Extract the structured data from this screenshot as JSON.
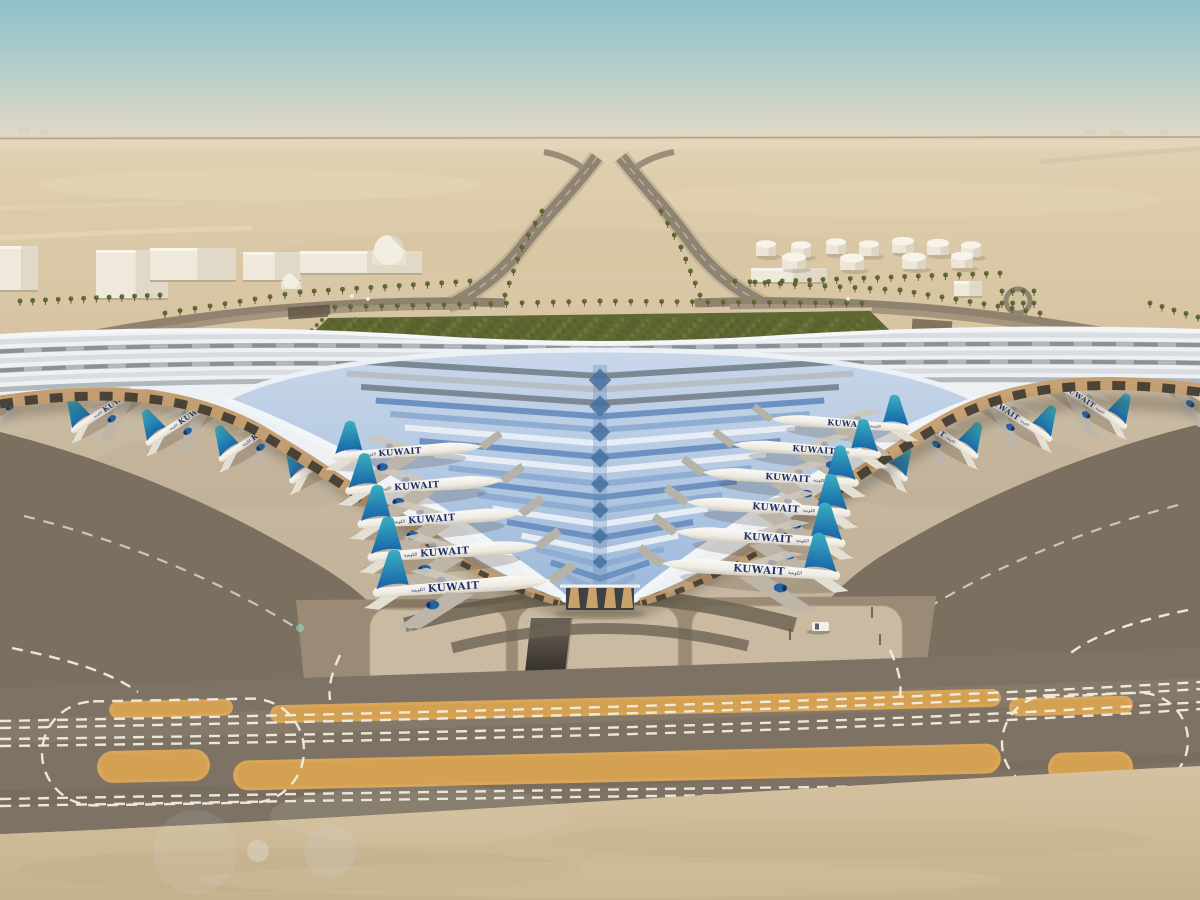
{
  "meta": {
    "title": "Aerial rendering of Kuwait International Airport Terminal 2 with Kuwait Airways fleet at gates",
    "scene_type": "architectural-rendering",
    "view": "aerial-oblique"
  },
  "airline": {
    "name": "KUWAIT",
    "arabic": "الكويتية",
    "wordmark_color": "#1d2e6b",
    "tail_teal": "#39b0bf",
    "tail_blue": "#1763a8"
  },
  "palette": {
    "sky_top": "#8fc2cb",
    "sky_horizon": "#e3d9c6",
    "desert": "#dbc9a8",
    "sand_foreground": "#d3c09e",
    "concrete_apron": "#c7b89f",
    "asphalt": "#7b7060",
    "taxiway_band": "#7d7264",
    "marking_white": "#f3eee1",
    "island_orange": "#d9a558",
    "roof_white": "#eef1f3",
    "glass_blue": "#9db8da",
    "glass_deep": "#47719f",
    "canopy_amber": "#c49d6e",
    "landscape_green": "#5f6833",
    "building_white": "#efe9db",
    "tank_white": "#ece6d8"
  },
  "counts": {
    "aircraft_visible": 21,
    "fuel_tanks": 11
  },
  "aircraft": {
    "left_concourse": [
      {
        "x": 402,
        "y": 452,
        "s": 0.94,
        "r": -4
      },
      {
        "x": 419,
        "y": 486,
        "s": 0.99,
        "r": -4
      },
      {
        "x": 434,
        "y": 519,
        "s": 1.03,
        "r": -4
      },
      {
        "x": 447,
        "y": 552,
        "s": 1.07,
        "r": -4
      },
      {
        "x": 456,
        "y": 587,
        "s": 1.12,
        "r": -4
      }
    ],
    "right_concourse": [
      {
        "x": 846,
        "y": 424,
        "s": 0.88,
        "r": -4
      },
      {
        "x": 812,
        "y": 450,
        "s": 0.93,
        "r": -4
      },
      {
        "x": 786,
        "y": 478,
        "s": 0.98,
        "r": -4
      },
      {
        "x": 774,
        "y": 508,
        "s": 1.03,
        "r": -4
      },
      {
        "x": 766,
        "y": 538,
        "s": 1.07,
        "r": -4
      },
      {
        "x": 757,
        "y": 570,
        "s": 1.12,
        "r": -4
      }
    ],
    "left_pier": [
      {
        "x": 18,
        "y": 388,
        "s": 0.78,
        "r": -33
      },
      {
        "x": 120,
        "y": 400,
        "s": 0.78,
        "r": -33
      },
      {
        "x": 196,
        "y": 412,
        "s": 0.8,
        "r": -33
      },
      {
        "x": 269,
        "y": 428,
        "s": 0.8,
        "r": -33
      },
      {
        "x": 341,
        "y": 449,
        "s": 0.82,
        "r": -33
      }
    ],
    "right_pier": [
      {
        "x": 1182,
        "y": 385,
        "s": 0.78,
        "r": -33
      },
      {
        "x": 1078,
        "y": 396,
        "s": 0.78,
        "r": -33
      },
      {
        "x": 1002,
        "y": 408,
        "s": 0.8,
        "r": -33
      },
      {
        "x": 928,
        "y": 425,
        "s": 0.8,
        "r": -33
      },
      {
        "x": 856,
        "y": 447,
        "s": 0.82,
        "r": -33
      }
    ]
  },
  "fuel_tanks": [
    {
      "x": 766,
      "y": 250,
      "r": 10
    },
    {
      "x": 801,
      "y": 251,
      "r": 10
    },
    {
      "x": 836,
      "y": 248,
      "r": 10
    },
    {
      "x": 869,
      "y": 250,
      "r": 10
    },
    {
      "x": 903,
      "y": 247,
      "r": 11
    },
    {
      "x": 938,
      "y": 249,
      "r": 11
    },
    {
      "x": 971,
      "y": 251,
      "r": 10
    },
    {
      "x": 794,
      "y": 263,
      "r": 12
    },
    {
      "x": 852,
      "y": 264,
      "r": 12
    },
    {
      "x": 914,
      "y": 263,
      "r": 12
    },
    {
      "x": 962,
      "y": 262,
      "r": 11
    }
  ],
  "buildings": [
    {
      "x": 0,
      "y": 246,
      "w": 38,
      "h": 46
    },
    {
      "x": 96,
      "y": 250,
      "w": 72,
      "h": 50
    },
    {
      "x": 150,
      "y": 248,
      "w": 86,
      "h": 34
    },
    {
      "x": 243,
      "y": 252,
      "w": 58,
      "h": 30
    },
    {
      "x": 300,
      "y": 251,
      "w": 122,
      "h": 24
    },
    {
      "x": 751,
      "y": 268,
      "w": 76,
      "h": 16
    },
    {
      "x": 954,
      "y": 281,
      "w": 28,
      "h": 17
    }
  ],
  "domes": [
    {
      "x": 389,
      "y": 250,
      "r": 15
    },
    {
      "x": 291,
      "y": 281,
      "r": 8
    }
  ],
  "palm_rows": [
    {
      "step": 15,
      "pts": [
        [
          335,
          312
        ],
        [
          600,
          306
        ],
        [
          862,
          308
        ]
      ]
    },
    {
      "step": 14,
      "pts": [
        [
          165,
          318
        ],
        [
          300,
          297
        ],
        [
          470,
          286
        ]
      ]
    },
    {
      "step": 14,
      "pts": [
        [
          1040,
          318
        ],
        [
          900,
          295
        ],
        [
          735,
          286
        ]
      ]
    },
    {
      "step": 12,
      "pts": [
        [
          505,
          300
        ],
        [
          522,
          252
        ],
        [
          542,
          216
        ]
      ]
    },
    {
      "step": 12,
      "pts": [
        [
          700,
          300
        ],
        [
          681,
          252
        ],
        [
          661,
          216
        ]
      ]
    },
    {
      "step": 13,
      "pts": [
        [
          755,
          287
        ],
        [
          1000,
          278
        ]
      ]
    },
    {
      "step": 12,
      "pts": [
        [
          20,
          306
        ],
        [
          160,
          300
        ]
      ]
    },
    {
      "step": 11,
      "pts": [
        [
          1150,
          308
        ],
        [
          1198,
          322
        ]
      ]
    },
    {
      "step": 9,
      "pts": [
        [
          1002,
          296
        ],
        [
          1034,
          296
        ]
      ]
    },
    {
      "step": 9,
      "pts": [
        [
          1002,
          308
        ],
        [
          1034,
          308
        ]
      ]
    }
  ],
  "islands": [
    {
      "x": 109,
      "y": 700,
      "w": 124,
      "h": 17,
      "rx": 9
    },
    {
      "x": 270,
      "y": 697,
      "w": 731,
      "h": 18,
      "rx": 9
    },
    {
      "x": 1009,
      "y": 697,
      "w": 124,
      "h": 18,
      "rx": 9
    },
    {
      "x": 97,
      "y": 750,
      "w": 113,
      "h": 32,
      "rx": 16
    },
    {
      "x": 233,
      "y": 752,
      "w": 768,
      "h": 30,
      "rx": 15
    },
    {
      "x": 1048,
      "y": 752,
      "w": 85,
      "h": 31,
      "rx": 15
    }
  ],
  "vehicles": [
    {
      "x": 812,
      "y": 622,
      "w": 17,
      "h": 9
    }
  ],
  "posts": [
    [
      790,
      640
    ],
    [
      880,
      645
    ],
    [
      872,
      618
    ]
  ],
  "cars": [
    [
      352,
      296
    ],
    [
      368,
      299
    ],
    [
      848,
      299
    ]
  ]
}
